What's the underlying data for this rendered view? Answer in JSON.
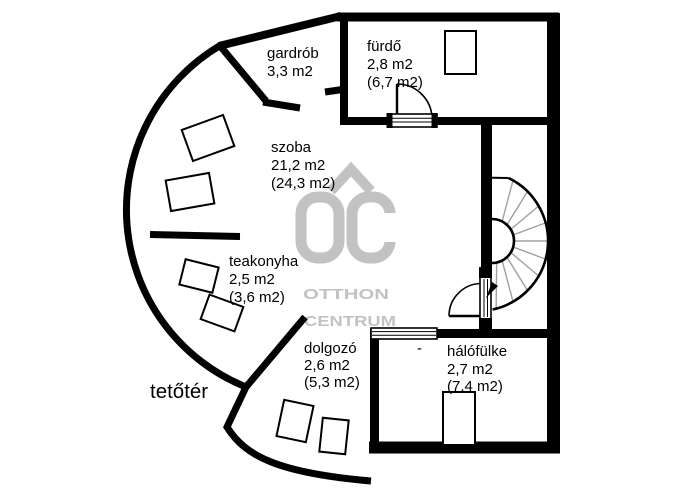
{
  "canvas": {
    "width": 694,
    "height": 491,
    "background": "#ffffff"
  },
  "palette": {
    "wall_color": "#000000",
    "text_color": "#000000",
    "watermark_gray": "#c2c2c2",
    "stair_step_gray": "#a0a0a0"
  },
  "watermark": {
    "logo_text": "OC",
    "brand_line1": "OTTHON",
    "brand_line2": "CENTRUM"
  },
  "floor_label": "tetőtér",
  "annotations": {
    "dash_marker": "-"
  },
  "rooms": [
    {
      "id": "gardrob",
      "name": "gardrób",
      "area": "3,3 m2",
      "area_gross": ""
    },
    {
      "id": "furdo",
      "name": "fürdő",
      "area": "2,8 m2",
      "area_gross": "(6,7 m2)"
    },
    {
      "id": "szoba",
      "name": "szoba",
      "area": "21,2 m2",
      "area_gross": "(24,3 m2)"
    },
    {
      "id": "teakonyha",
      "name": "teakonyha",
      "area": "2,5 m2",
      "area_gross": "(3,6 m2)"
    },
    {
      "id": "dolgozo",
      "name": "dolgozó",
      "area": "2,6 m2",
      "area_gross": "(5,3 m2)"
    },
    {
      "id": "halofulke",
      "name": "hálófülke",
      "area": "2,7 m2",
      "area_gross": "(7,4 m2)"
    }
  ]
}
